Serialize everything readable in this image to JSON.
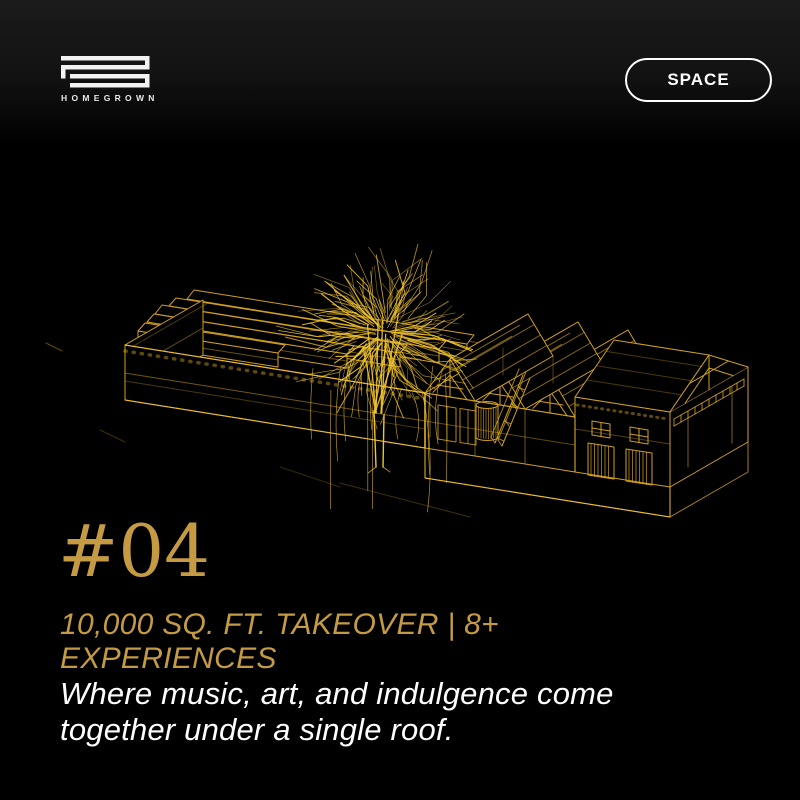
{
  "header": {
    "brand": "HOMEGROWN",
    "nav": {
      "space_label": "SPACE"
    }
  },
  "hero": {
    "number": "#04",
    "subtitle": {
      "line1": "10,000 SQ. FT. TAKEOVER | 8+",
      "line2": "EXPERIENCES"
    },
    "description": {
      "line1": "Where music, art, and indulgence come",
      "line2": "together under a single roof."
    },
    "illustration_name": "gold-wireframe-warehouse-with-tree"
  },
  "colors": {
    "background": "#000000",
    "header_background": "#161616",
    "gold_text": "#C49A42",
    "gold_line": "#CF9F1D",
    "gold_bright": "#F2C52F",
    "white": "#FFFFFF"
  }
}
